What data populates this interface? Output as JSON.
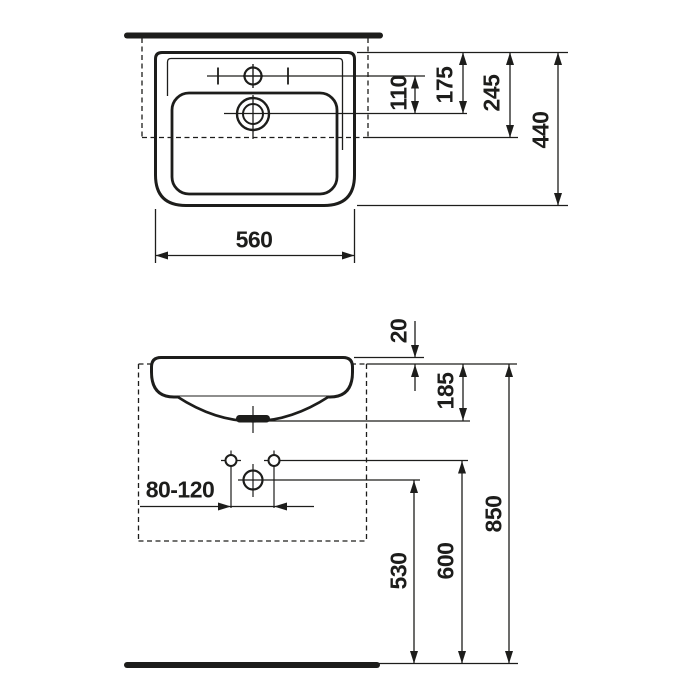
{
  "colors": {
    "ink": "#1d1d1b",
    "background": "#ffffff"
  },
  "top_view": {
    "description": "washbasin seen from above",
    "dims": {
      "width": "560",
      "tap_hole_to_drain": "110",
      "rear_edge_to_drain": "175",
      "rear_edge_to_cutout_line": "245",
      "depth": "440"
    }
  },
  "front_view": {
    "description": "washbasin front elevation with installation heights",
    "dims": {
      "rim_above_counter": "20",
      "counter_to_bowl_underside": "185",
      "fixing_holes_range": "80-120",
      "drain_center_height": "530",
      "fixing_holes_height": "600",
      "rim_height_from_floor": "850"
    }
  }
}
